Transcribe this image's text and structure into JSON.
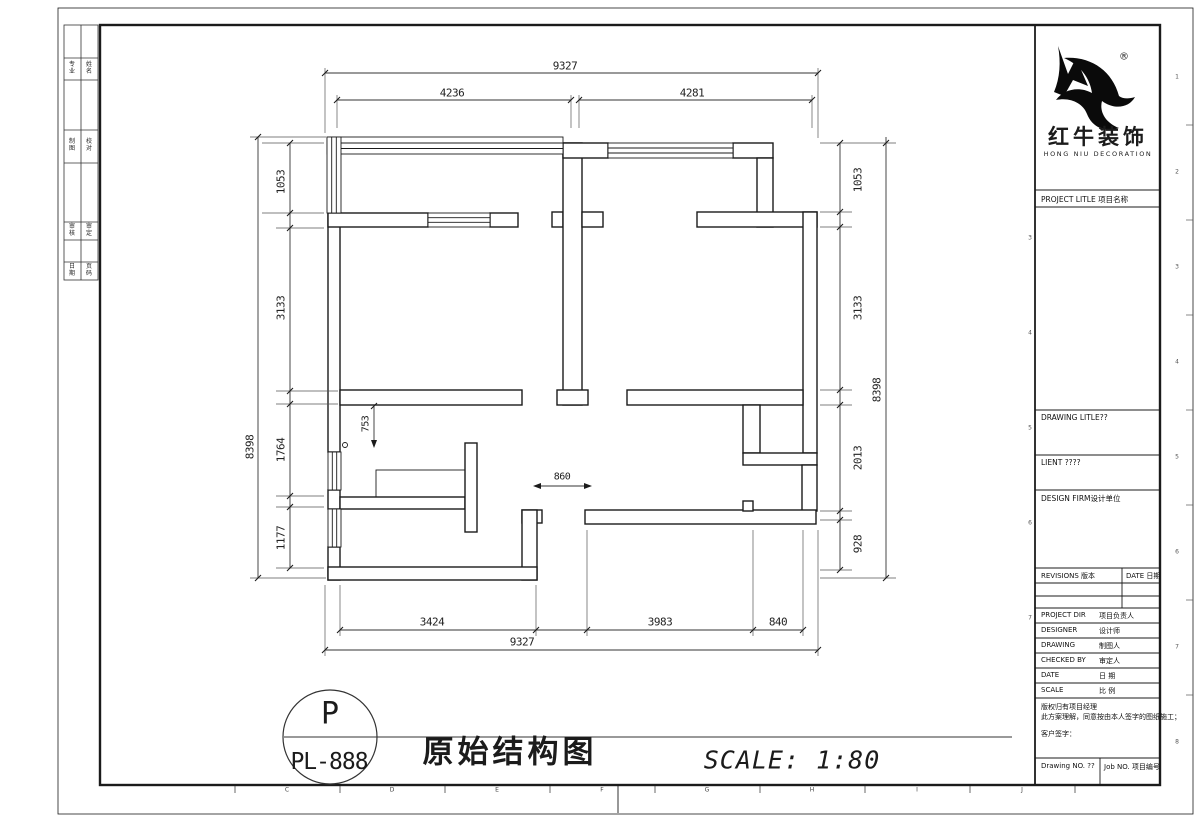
{
  "frame": {
    "strip_rows": [
      [
        "专业",
        "姓名"
      ],
      [
        "制图",
        "校对"
      ],
      [
        "审核",
        "审定"
      ],
      [
        "日期",
        "页码"
      ]
    ],
    "zone_numbers": [
      "1",
      "2",
      "3",
      "4",
      "5",
      "6",
      "7",
      "8"
    ],
    "ruler_letters": [
      "C",
      "D",
      "E",
      "F",
      "G",
      "H",
      "I",
      "J"
    ]
  },
  "logo": {
    "reg": "®",
    "cn": "红牛装饰",
    "en": "HONG NIU DECORATION"
  },
  "titleblock": {
    "project_title": "PROJECT LITLE  项目名称",
    "drawing_title": "DRAWING LITLE??",
    "client": "LIENT ????",
    "design_firm": "DESIGN FIRM设计单位",
    "revisions": "REVISIONS 版本",
    "date_col": "DATE 日期",
    "project_dir_en": "PROJECT DIR",
    "project_dir_cn": "项目负责人",
    "designer_en": "DESIGNER",
    "designer_cn": "设计师",
    "drawing_en": "DRAWING",
    "drawing_cn": "制图人",
    "checked_en": "CHECKED BY",
    "checked_cn": "审定人",
    "date_en": "DATE",
    "date_cn": "日 期",
    "scale_en": "SCALE",
    "scale_cn": "比 例",
    "disclaimer1": "版权归有项目经理",
    "disclaimer2": "此方案理解，同意按由本人签字的图纸施工；",
    "customer_sign": "客户签字：",
    "drawing_no": "Drawing NO. ??",
    "job_no": "Job NO. 项目编号"
  },
  "titlebar": {
    "bubble_letter": "P",
    "bubble_code": "PL-888",
    "drawing_name": "原始结构图",
    "scale_text": "SCALE: 1:80"
  },
  "dims": {
    "top_overall": "9327",
    "top_left": "4236",
    "top_right": "4281",
    "left_overall": "8398",
    "left_chain": [
      "1053",
      "3133",
      "1764",
      "1177"
    ],
    "right_overall": "8398",
    "right_chain": [
      "1053",
      "3133",
      "2013",
      "928"
    ],
    "bottom_overall": "9327",
    "bottom_chain": [
      "3424",
      "3983",
      "840"
    ],
    "dim_753": "753",
    "dim_860": "860"
  }
}
